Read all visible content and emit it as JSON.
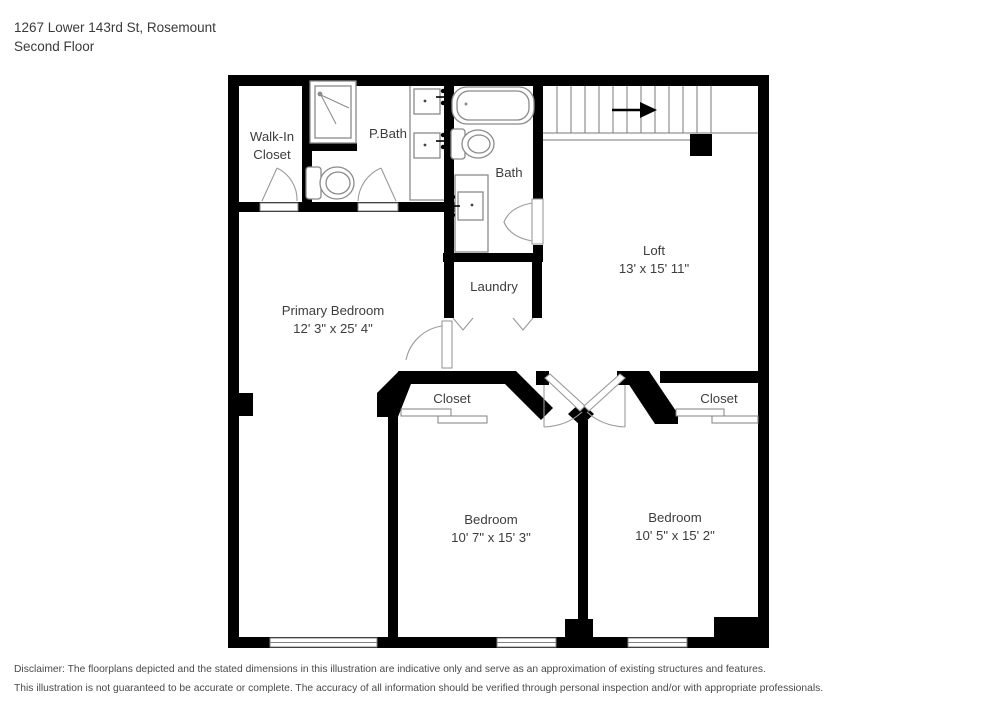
{
  "header": {
    "address": "1267 Lower 143rd St, Rosemount",
    "floor": "Second Floor"
  },
  "rooms": {
    "walk_in_closet": {
      "line1": "Walk-In",
      "line2": "Closet"
    },
    "p_bath": {
      "name": "P.Bath"
    },
    "bath": {
      "name": "Bath"
    },
    "loft": {
      "name": "Loft",
      "dims": "13' x 15' 11\""
    },
    "laundry": {
      "name": "Laundry"
    },
    "primary_bedroom": {
      "name": "Primary Bedroom",
      "dims": "12' 3\" x 25' 4\""
    },
    "closet_left": {
      "name": "Closet"
    },
    "closet_right": {
      "name": "Closet"
    },
    "bedroom_left": {
      "name": "Bedroom",
      "dims": "10' 7\" x 15' 3\""
    },
    "bedroom_right": {
      "name": "Bedroom",
      "dims": "10' 5\" x 15' 2\""
    }
  },
  "footer": {
    "line1": "Disclaimer: The floorplans depicted and the stated dimensions in this illustration are indicative only and serve as an approximation of existing structures and features.",
    "line2": "This illustration is not guaranteed to be accurate or complete. The accuracy of all information should be verified through personal inspection and/or with appropriate professionals."
  },
  "colors": {
    "wall": "#000000",
    "fixture_stroke": "#8a8a8a",
    "text": "#3d3d3d"
  }
}
